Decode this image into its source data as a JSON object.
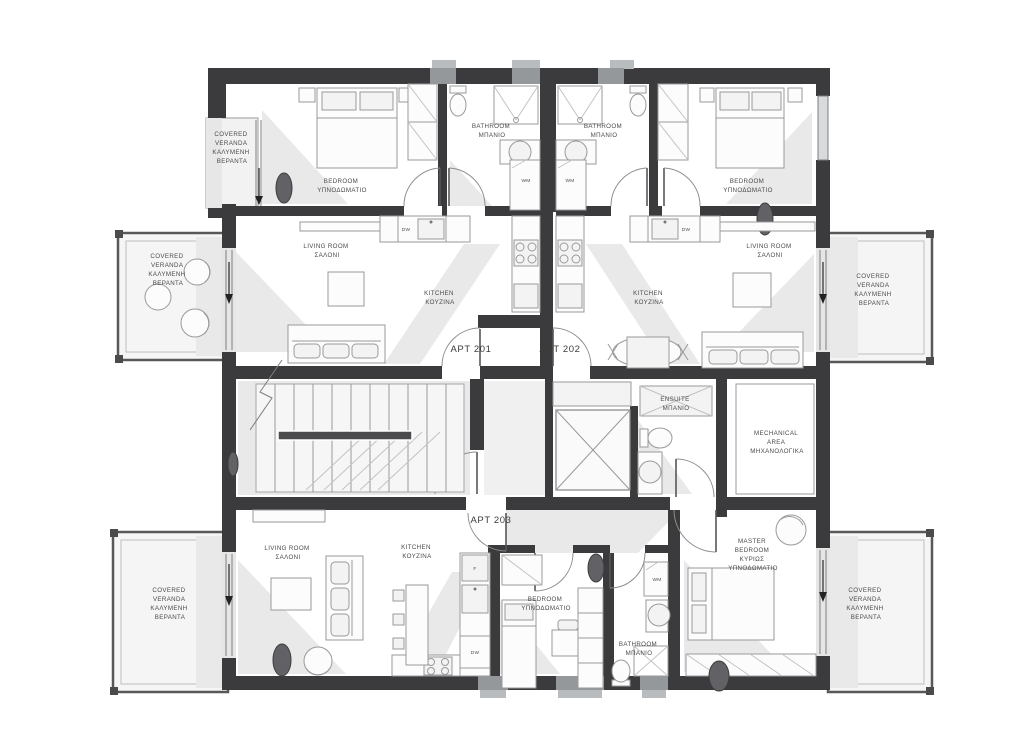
{
  "plan": {
    "title": "Apartment building floor plan",
    "apartments": {
      "apt201": "APT 201",
      "apt202": "APT 202",
      "apt203": "APT 203"
    },
    "room_labels": {
      "covered_veranda": [
        "COVERED",
        "VERANDA",
        "ΚΑΛΥΜΕΝΗ",
        "ΒΕΡΑΝΤΑ"
      ],
      "bedroom": [
        "BEDROOM",
        "ΥΠΝΟΔΩΜΑΤΙΟ"
      ],
      "bathroom": [
        "BATHROOM",
        "ΜΠΑΝΙΟ"
      ],
      "living_room": [
        "LIVING ROOM",
        "ΣΑΛΟΝΙ"
      ],
      "kitchen": [
        "KITCHEN",
        "ΚΟΥΖΙΝΑ"
      ],
      "ensuite": [
        "ENSUITE",
        "ΜΠΑΝΙΟ"
      ],
      "mechanical": [
        "MECHANICAL",
        "AREA",
        "ΜΗΧΑΝΟΛΟΓΙΚΑ"
      ],
      "master_bedroom": [
        "MASTER",
        "BEDROOM",
        "ΚΥΡΙΩΣ",
        "ΥΠΝΟΔΩΜΑΤΙΟ"
      ]
    },
    "appliance_labels": {
      "washing_machine": "WM",
      "dishwasher": "DW",
      "fridge": "F"
    },
    "colors": {
      "wall": "#3b3b3d",
      "wall_window": "#94989b",
      "floor": "#ffffff",
      "shadow": "#e9e9e9",
      "furniture_stroke": "#9a9a9a",
      "text": "#4b4b4b",
      "plant": "#626266"
    }
  }
}
